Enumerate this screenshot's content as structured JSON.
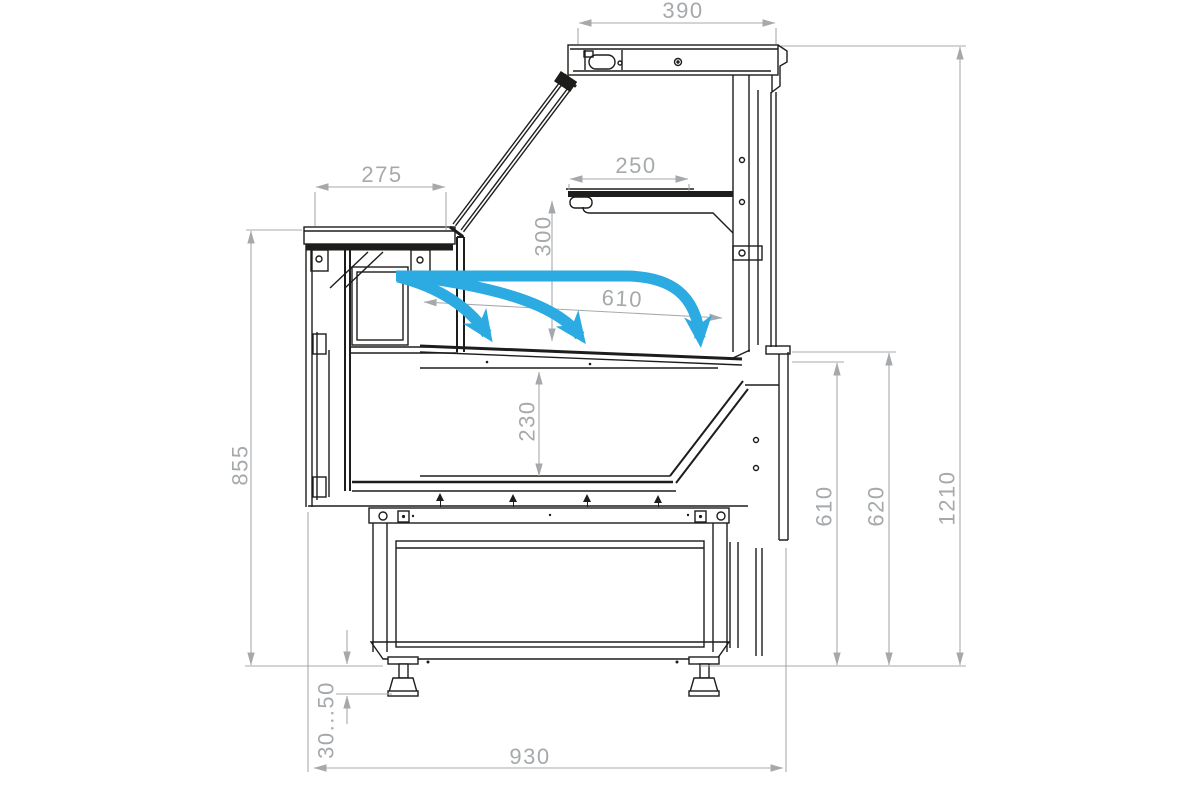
{
  "drawing": {
    "type": "technical-cross-section",
    "subject": "refrigerated serve-over display counter, side section view with cold airflow curtain",
    "units": "mm",
    "colors": {
      "line": "#1d1d1b",
      "dimension": "#a6a9ab",
      "airflow": "#2caae2",
      "background": "#ffffff"
    },
    "dimensions": {
      "canopy_width": {
        "value": "390"
      },
      "rear_worktop_depth": {
        "value": "275"
      },
      "shelf_depth": {
        "value": "250"
      },
      "shelf_to_deck": {
        "value": "300"
      },
      "deck_depth": {
        "value": "610"
      },
      "well_depth": {
        "value": "230"
      },
      "rear_worktop_height": {
        "value": "855"
      },
      "front_deck_height": {
        "value": "610"
      },
      "front_edge_height": {
        "value": "620"
      },
      "overall_height": {
        "value": "1210"
      },
      "foot_adjust_range": {
        "value": "30...50"
      },
      "overall_depth": {
        "value": "930"
      }
    },
    "airflow": {
      "color": "#2caae2",
      "arrow_count": 3,
      "description": "cold air curtain over display deck"
    }
  }
}
